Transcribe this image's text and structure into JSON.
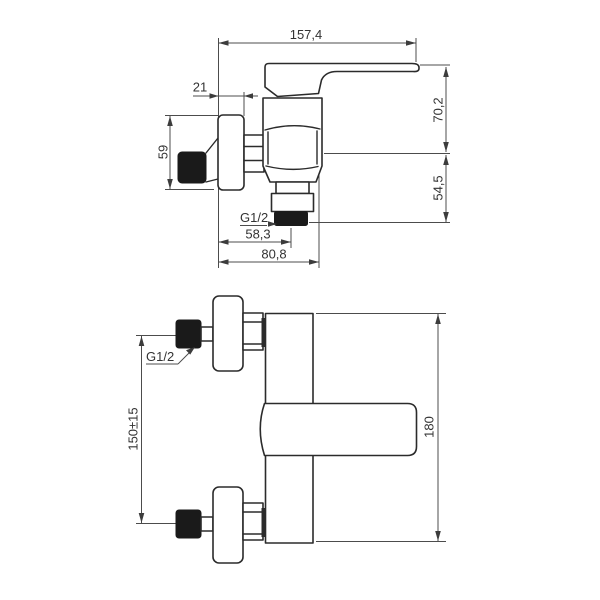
{
  "drawing": {
    "type": "technical-dimension-drawing",
    "subject": "wall-mounted single-lever shower mixer tap, side view above and front view below",
    "colors": {
      "background": "#ffffff",
      "part_outline": "#2b2b2b",
      "dark_fill": "#1a1a1a",
      "dimension_line": "#4c4c4c",
      "text": "#333333"
    },
    "side_view": {
      "total_length": "157,4",
      "wall_to_rosette": "21",
      "axis_to_handle_top": "70,2",
      "axis_to_outlet": "54,5",
      "rosette_size": "59",
      "outlet_thread": "G1/2",
      "wall_to_outlet_center": "58,3",
      "wall_to_body_front": "80,8"
    },
    "front_view": {
      "inlet_thread": "G1/2",
      "inlet_center_distance": "150±15",
      "body_height": "180"
    }
  }
}
